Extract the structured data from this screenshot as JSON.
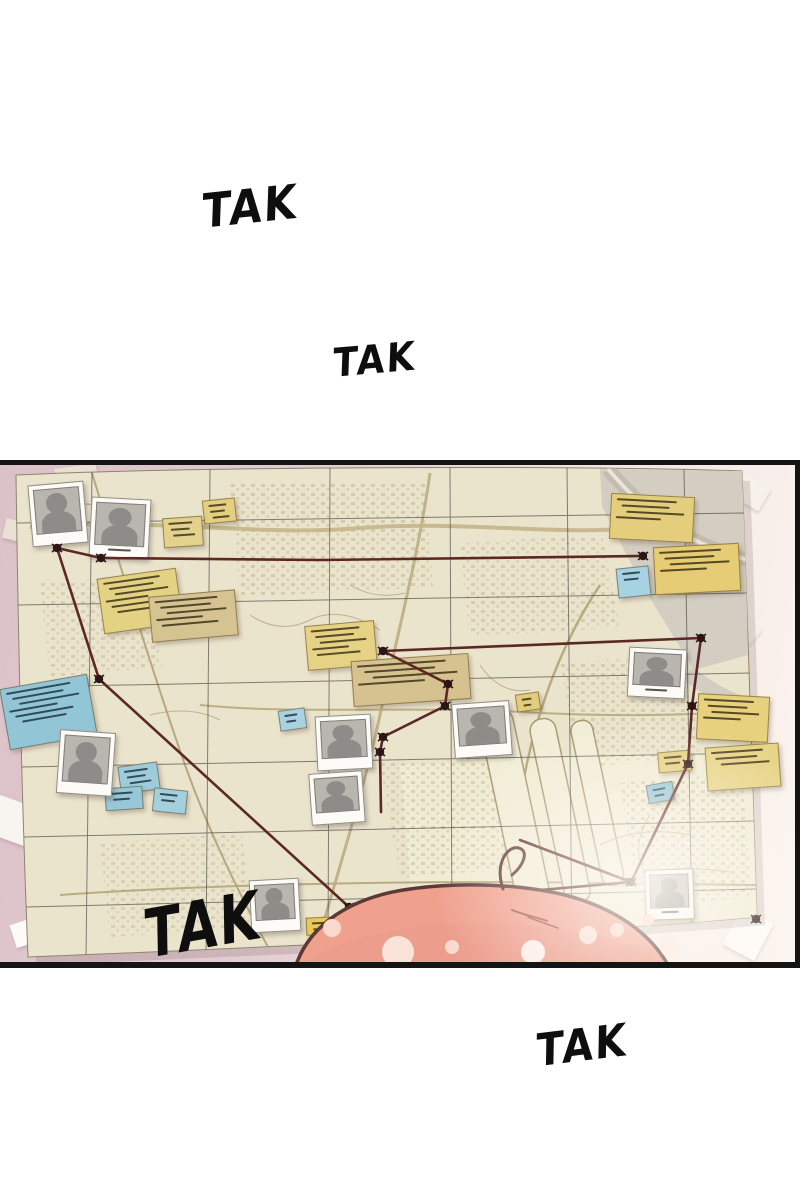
{
  "scene": {
    "type": "comic-panel",
    "sfx": {
      "items": [
        {
          "text": "TAK",
          "position": "top-left"
        },
        {
          "text": "TAK",
          "position": "upper-middle"
        },
        {
          "text": "TAK",
          "position": "bottom-left-of-panel"
        },
        {
          "text": "TAK",
          "position": "bottom-right"
        }
      ]
    }
  },
  "board": {
    "elements": {
      "map": {
        "icon": "city-map",
        "count": 1
      },
      "photos": {
        "icon": "person-silhouette-photo",
        "count": 9
      },
      "sticky_notes_yellow": {
        "icon": "sticky-note",
        "count": 13
      },
      "sticky_notes_blue": {
        "icon": "sticky-note",
        "count": 8
      },
      "pins": {
        "icon": "push-pin",
        "count": 15
      },
      "string_network": {
        "icon": "red-string",
        "count": 1
      },
      "tape_scraps": {
        "icon": "paper-scrap",
        "count": 9
      },
      "character_head": {
        "icon": "pink-haired-head",
        "count": 1
      }
    }
  },
  "colors": {
    "page_background": "#ffffff",
    "panel_border": "#141414",
    "wall_pink": "#dbc2c8",
    "map_paper": "#ebe4cd",
    "map_ink": "#a99c72",
    "note_yellow": "#e4cf80",
    "note_khaki": "#d6c392",
    "note_blue": "#9accdb",
    "note_scribble": "#3c3217",
    "note_scribble_blue": "#1e3642",
    "string_red": "#5b2824",
    "pin_dark": "#2c1616",
    "photo_frame": "#fcfbf7",
    "silhouette_gray": "#8e8c88",
    "hair_salmon": "#f0a18e",
    "hair_outline": "#5c3836",
    "sfx_ink": "#0e0e0e"
  }
}
